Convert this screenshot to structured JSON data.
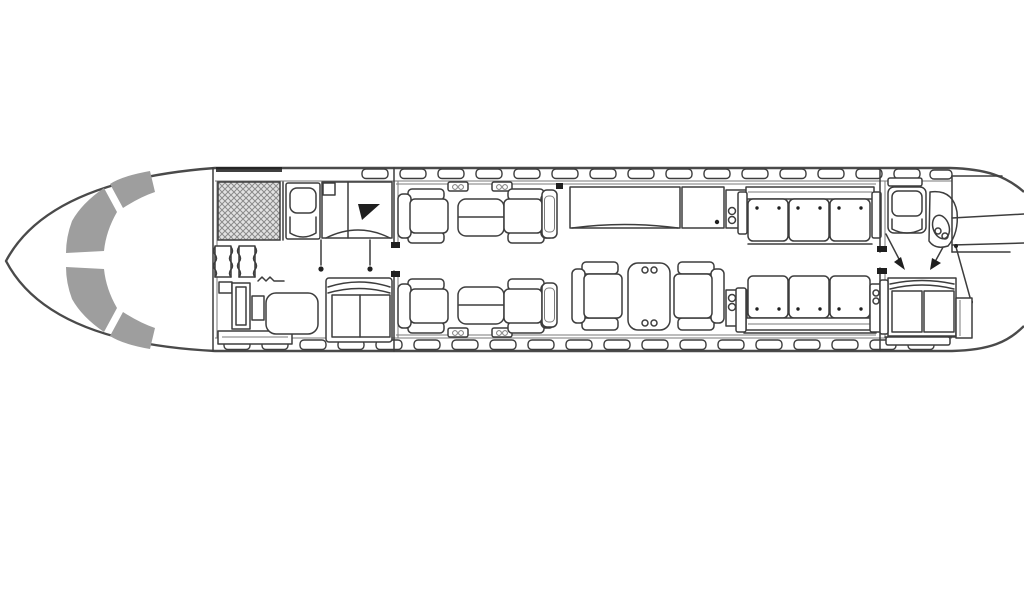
{
  "diagram": {
    "type": "aircraft-cabin-floor-plan",
    "description": "Business jet interior floor plan, top view, nose pointing left, no visible text labels",
    "orientation": "nose-left",
    "colors": {
      "background": "#ffffff",
      "line": "#3d3d3d",
      "line_light": "#7a7a7a",
      "windshield_fill": "#9e9e9e",
      "galley_fill": "#e2e2e2",
      "galley_hatch": "#8a8a8a",
      "black_fill": "#1f1f1f"
    },
    "components": [
      {
        "name": "fuselage-outline"
      },
      {
        "name": "cockpit-windshield"
      },
      {
        "name": "galley"
      },
      {
        "name": "forward-single-seat"
      },
      {
        "name": "forward-cabinet"
      },
      {
        "name": "entry-vestibule-curtains"
      },
      {
        "name": "entry-stair-cabinet"
      },
      {
        "name": "ottoman"
      },
      {
        "name": "forward-settee"
      },
      {
        "name": "club-seat-top-forward"
      },
      {
        "name": "club-seat-top-aft"
      },
      {
        "name": "club-table-top"
      },
      {
        "name": "club-seat-bottom-forward"
      },
      {
        "name": "club-seat-bottom-aft"
      },
      {
        "name": "club-table-bottom"
      },
      {
        "name": "mid-console-top"
      },
      {
        "name": "mid-console-bottom"
      },
      {
        "name": "credenza"
      },
      {
        "name": "aft-cabinet"
      },
      {
        "name": "end-table-top"
      },
      {
        "name": "end-table-bottom"
      },
      {
        "name": "conference-seat-forward"
      },
      {
        "name": "conference-seat-aft"
      },
      {
        "name": "conference-table"
      },
      {
        "name": "divan-top"
      },
      {
        "name": "divan-bottom"
      },
      {
        "name": "aft-chair"
      },
      {
        "name": "toilet"
      },
      {
        "name": "baggage-compartment"
      },
      {
        "name": "aft-sofa"
      },
      {
        "name": "aft-wardrobe"
      },
      {
        "name": "lavatory-door-swing"
      },
      {
        "name": "access-arrows"
      },
      {
        "name": "cabin-windows-top"
      },
      {
        "name": "cabin-windows-bottom"
      }
    ]
  }
}
